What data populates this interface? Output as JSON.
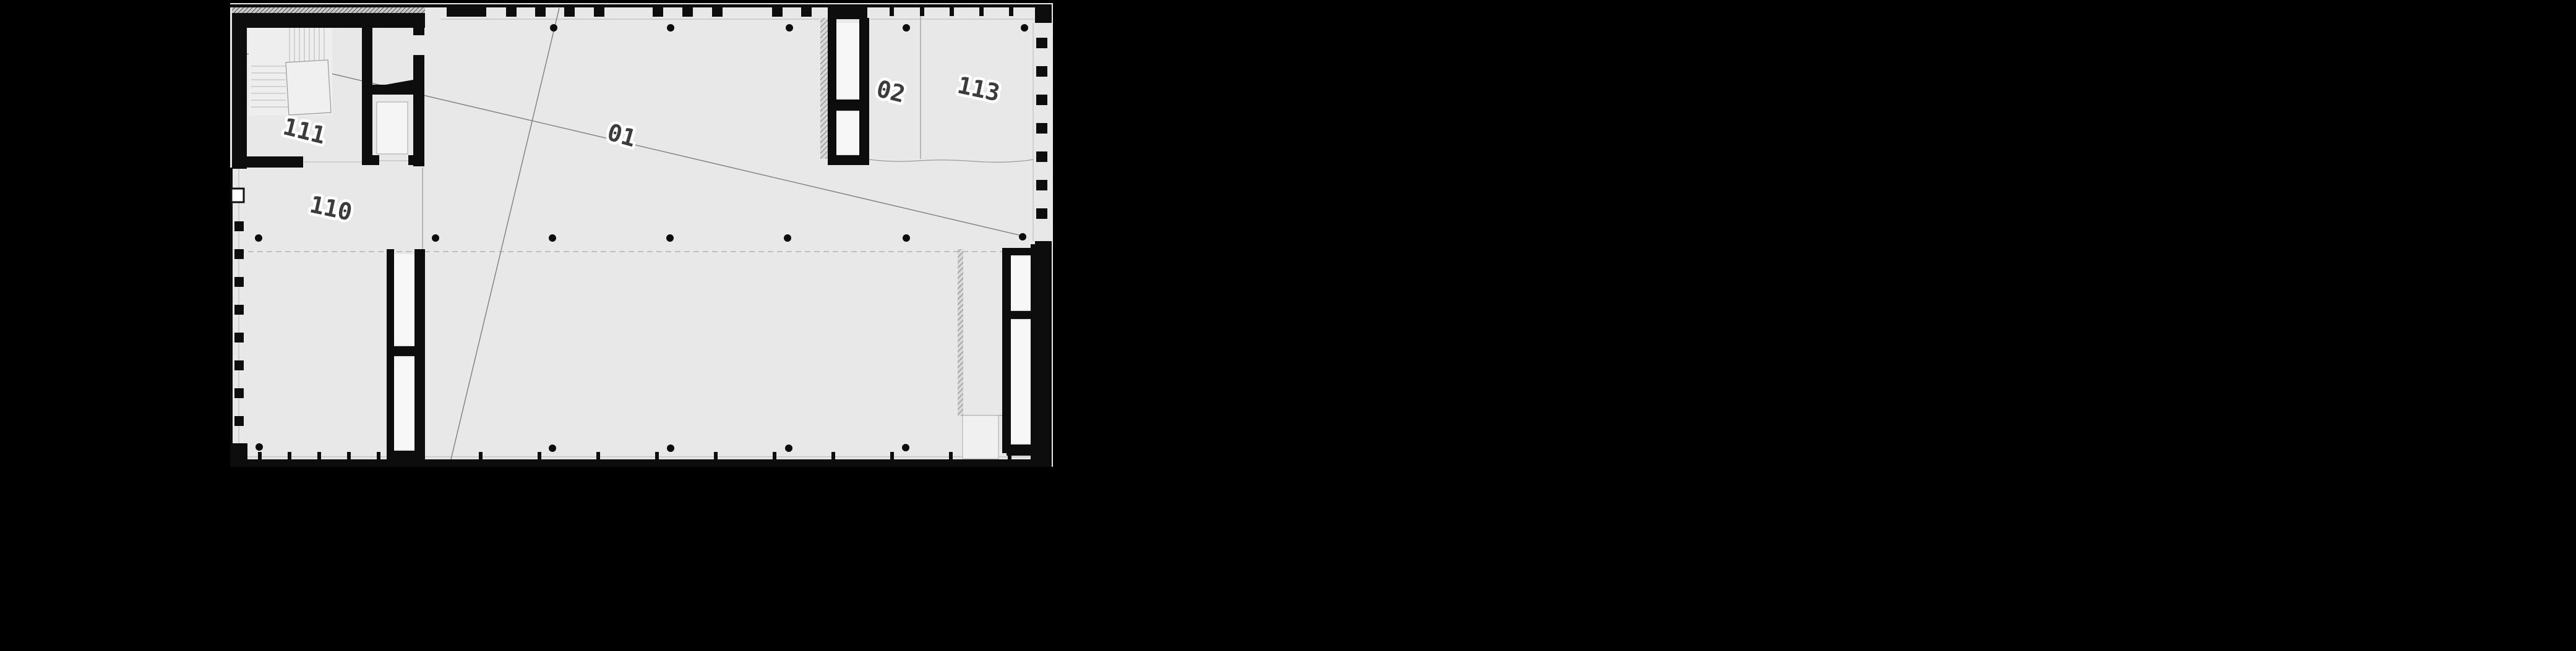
{
  "plan": {
    "labels": {
      "room_111": "111",
      "room_110": "110",
      "axis_01": "01",
      "stair_02": "02",
      "room_113": "113"
    },
    "colors": {
      "page_background": "#000000",
      "floor": "#e8e8e8",
      "wall": "#0d0d0d",
      "thin_line": "#9a9a9a",
      "label_text": "#3c3c3c",
      "label_halo": "#ffffff"
    }
  }
}
